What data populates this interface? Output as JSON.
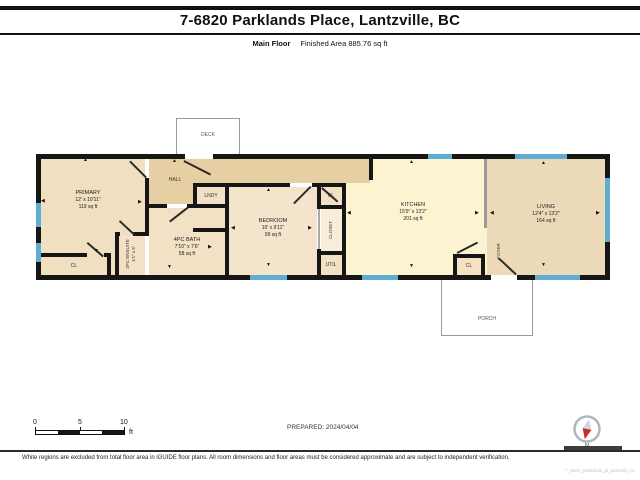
{
  "header": {
    "title": "7-6820 Parklands Place, Lantzville, BC",
    "floor": "Main Floor",
    "finished_area": "Finished Area 885.76 sq ft"
  },
  "rooms": {
    "primary": {
      "name": "PRIMARY",
      "dims": "12' x 10'11\"",
      "area": "119 sq ft"
    },
    "hall": {
      "name": "HALL"
    },
    "lndy": {
      "name": "LNDY"
    },
    "bath": {
      "name": "4PC BATH",
      "dims": "7'10\" x 7'6\"",
      "area": "58 sq ft"
    },
    "ensuite": {
      "name": "2PC ENSUITE",
      "dims": "4'1\" x 5'"
    },
    "primary_closet": {
      "name": "CL"
    },
    "bedroom": {
      "name": "BEDROOM",
      "dims": "10' x 9'11\"",
      "area": "99 sq ft"
    },
    "bedroom_closet": {
      "name": "CL"
    },
    "closet": {
      "name": "CLOSET"
    },
    "util": {
      "name": "UTIL"
    },
    "kitchen": {
      "name": "KITCHEN",
      "dims": "15'9\" x 13'2\"",
      "area": "201 sq ft"
    },
    "kitchen_closet": {
      "name": "CL"
    },
    "foyer": {
      "name": "FOYER"
    },
    "living": {
      "name": "LIVING",
      "dims": "12'4\" x 13'2\"",
      "area": "164 sq ft"
    },
    "deck": {
      "name": "DECK"
    },
    "porch": {
      "name": "PORCH"
    }
  },
  "icons": {
    "arrow_up": "▲",
    "arrow_down": "▼",
    "arrow_left": "◀",
    "arrow_right": "▶"
  },
  "footer": {
    "scale": {
      "ticks": [
        "0",
        "5",
        "10"
      ],
      "unit": "ft"
    },
    "prepared": "PREPARED: 2024/04/04",
    "compass_label": "N",
    "disclaimer": "White regions are excluded from total floor area in iGUIDE floor plans. All room dimensions and floor areas must be considered approximate and are subject to independent verification.",
    "plan_id": "7_6820_parklands_pl_lantzville_bc"
  },
  "colors": {
    "wall": "#161616",
    "window": "#5fadd1",
    "hall": "#e6cfa3",
    "room": "#f3e1c6",
    "kitchen": "#fcf3d1",
    "living": "#ecd9b7"
  }
}
